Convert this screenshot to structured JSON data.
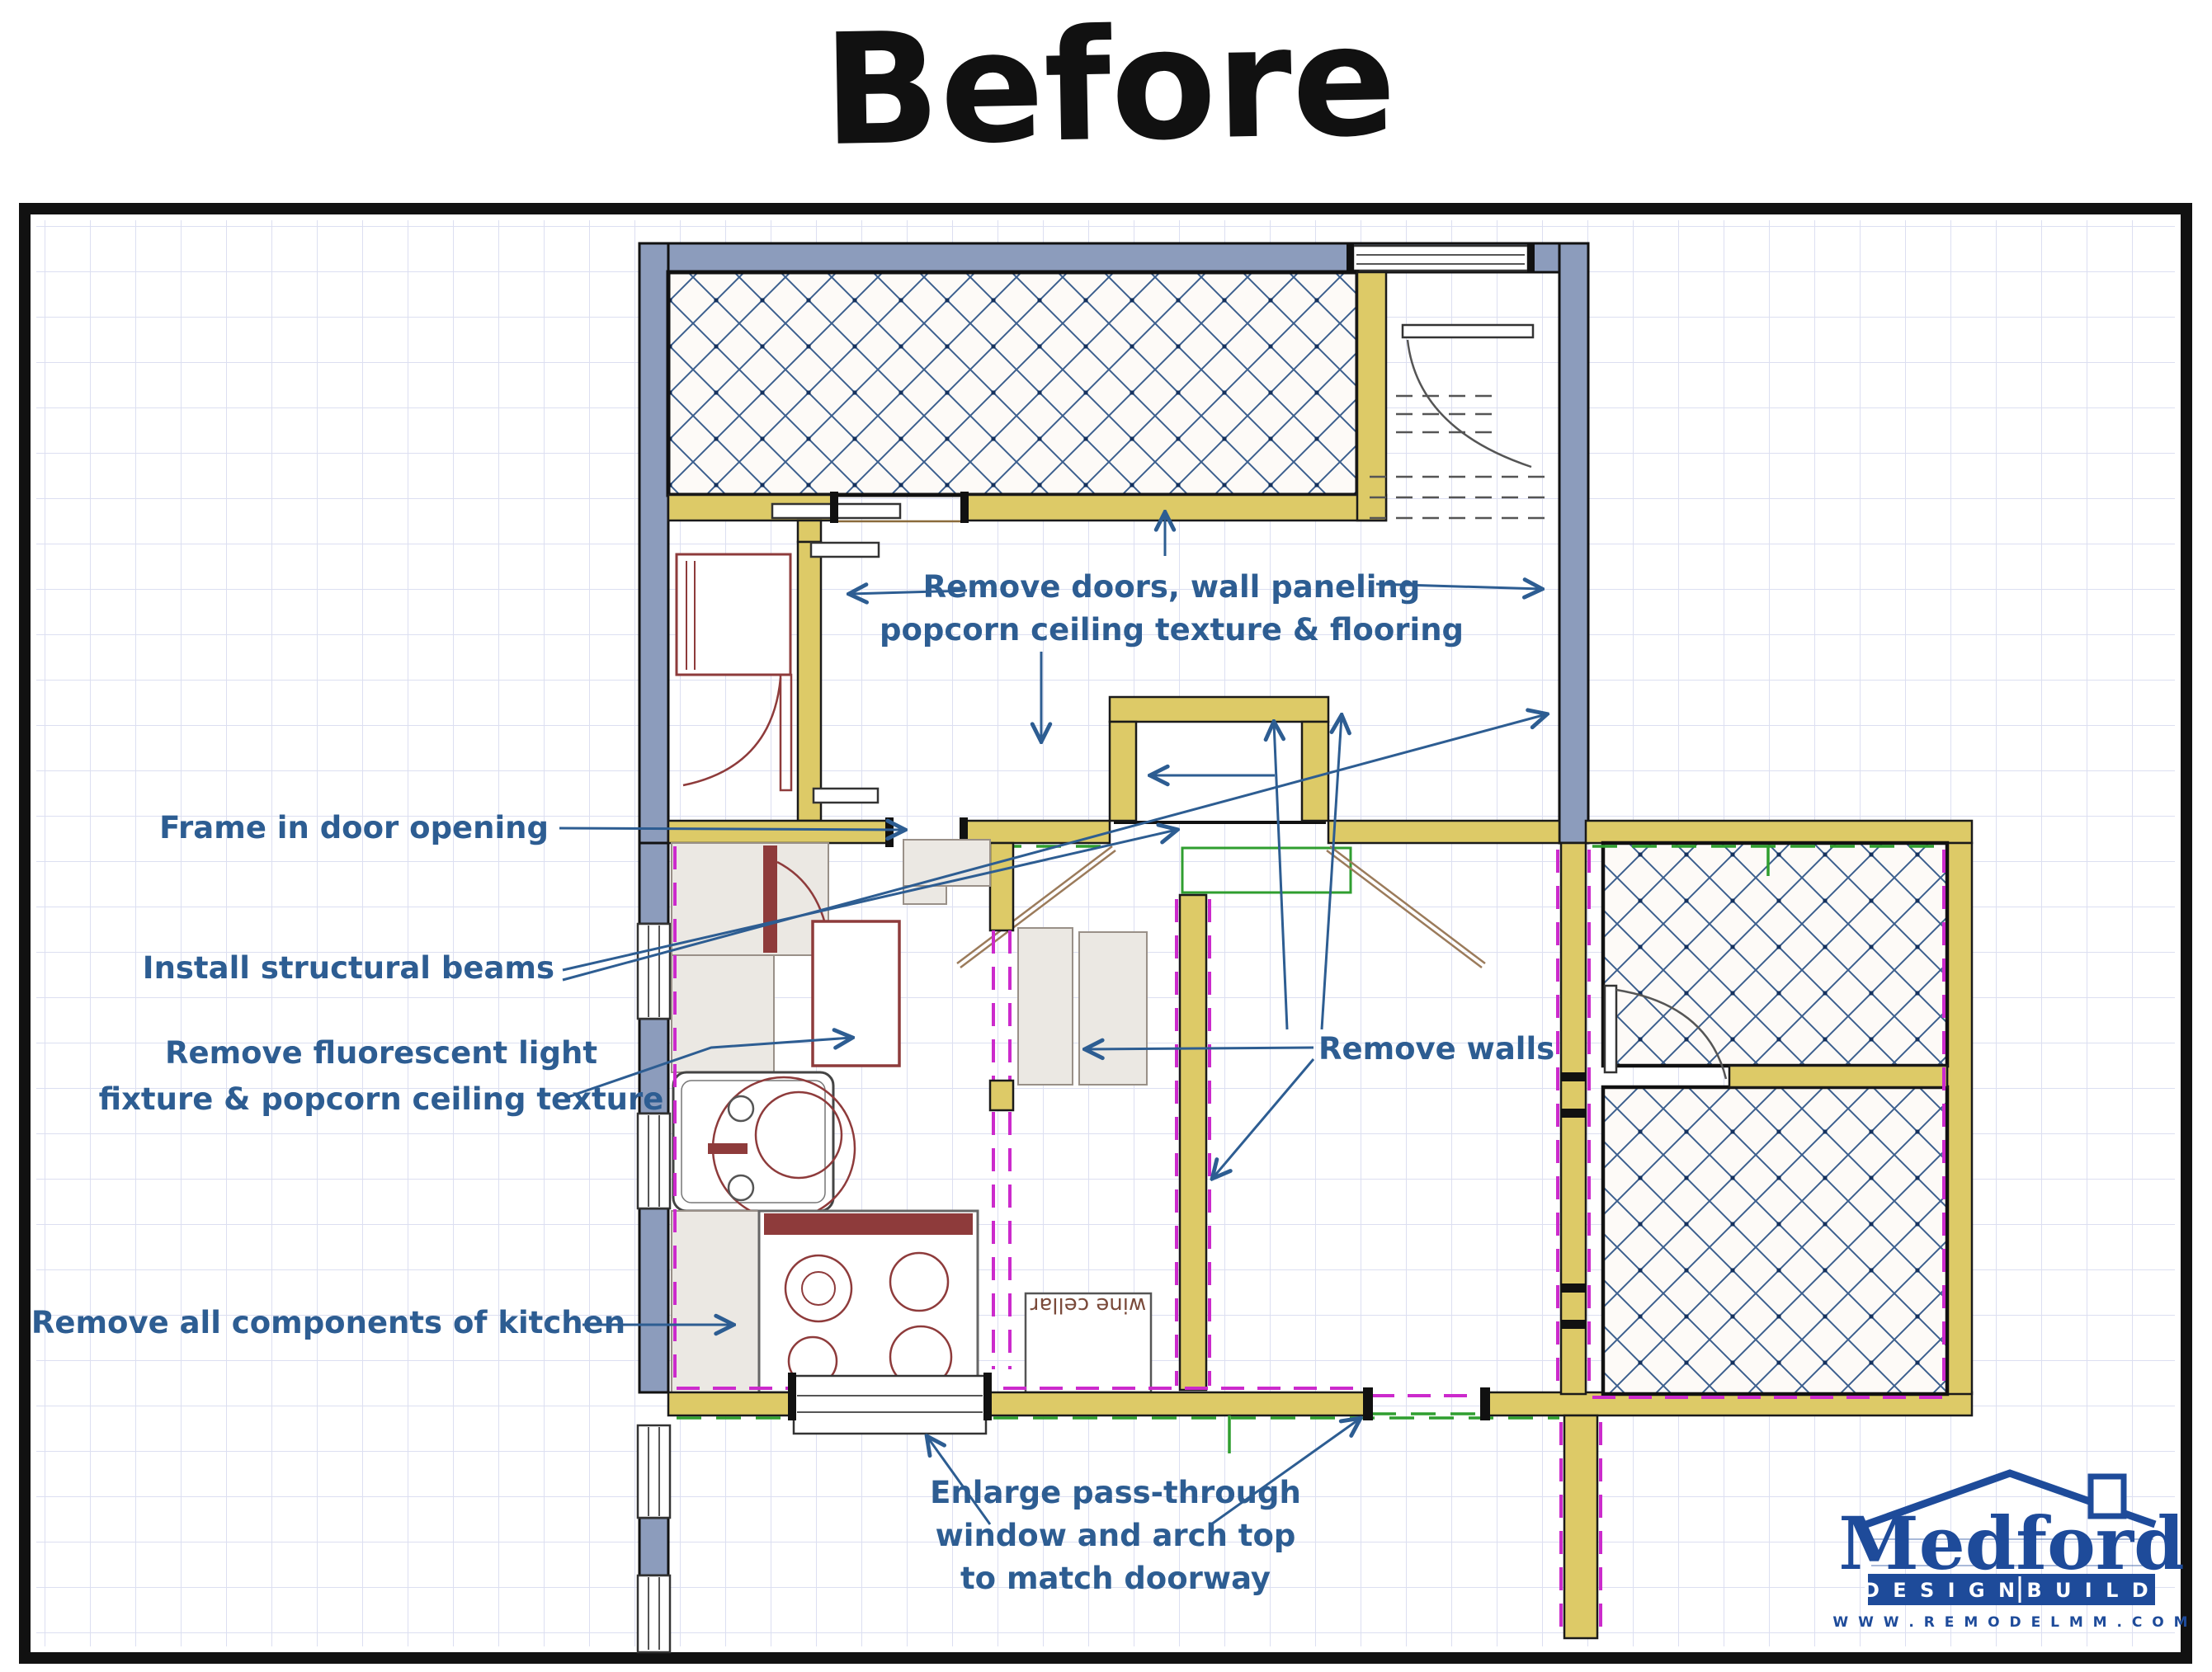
{
  "title": "Before",
  "plan": {
    "annotations": {
      "remove_doors_line1": "Remove doors, wall paneling",
      "remove_doors_line2": "popcorn ceiling texture & flooring",
      "frame_door": "Frame in door opening",
      "install_beams": "Install structural beams",
      "remove_fluorescent_line1": "Remove fluorescent light",
      "remove_fluorescent_line2": "fixture & popcorn ceiling texture",
      "remove_walls": "Remove walls",
      "remove_kitchen": "Remove all components of kitchen",
      "enlarge_line1": "Enlarge pass-through",
      "enlarge_line2": "window and arch top",
      "enlarge_line3": "to match doorway"
    },
    "labels": {
      "wine_cellar": "wine cellar"
    },
    "colors": {
      "wall_yellow": "#ddca67",
      "wall_gray": "#8c9cbc",
      "hatch_blue": "#3c5f8e",
      "remove_magenta": "#cc2acc",
      "beam_green": "#2f9e2f",
      "annotation_blue": "#2d5d92",
      "fixture_red": "#8e3b3b",
      "logo_blue": "#1e4b9a"
    }
  },
  "logo": {
    "name": "Medford",
    "design": "D E S I G N",
    "build": "B U I L D",
    "website": "W W W . R E M O D E L M M . C O M"
  }
}
